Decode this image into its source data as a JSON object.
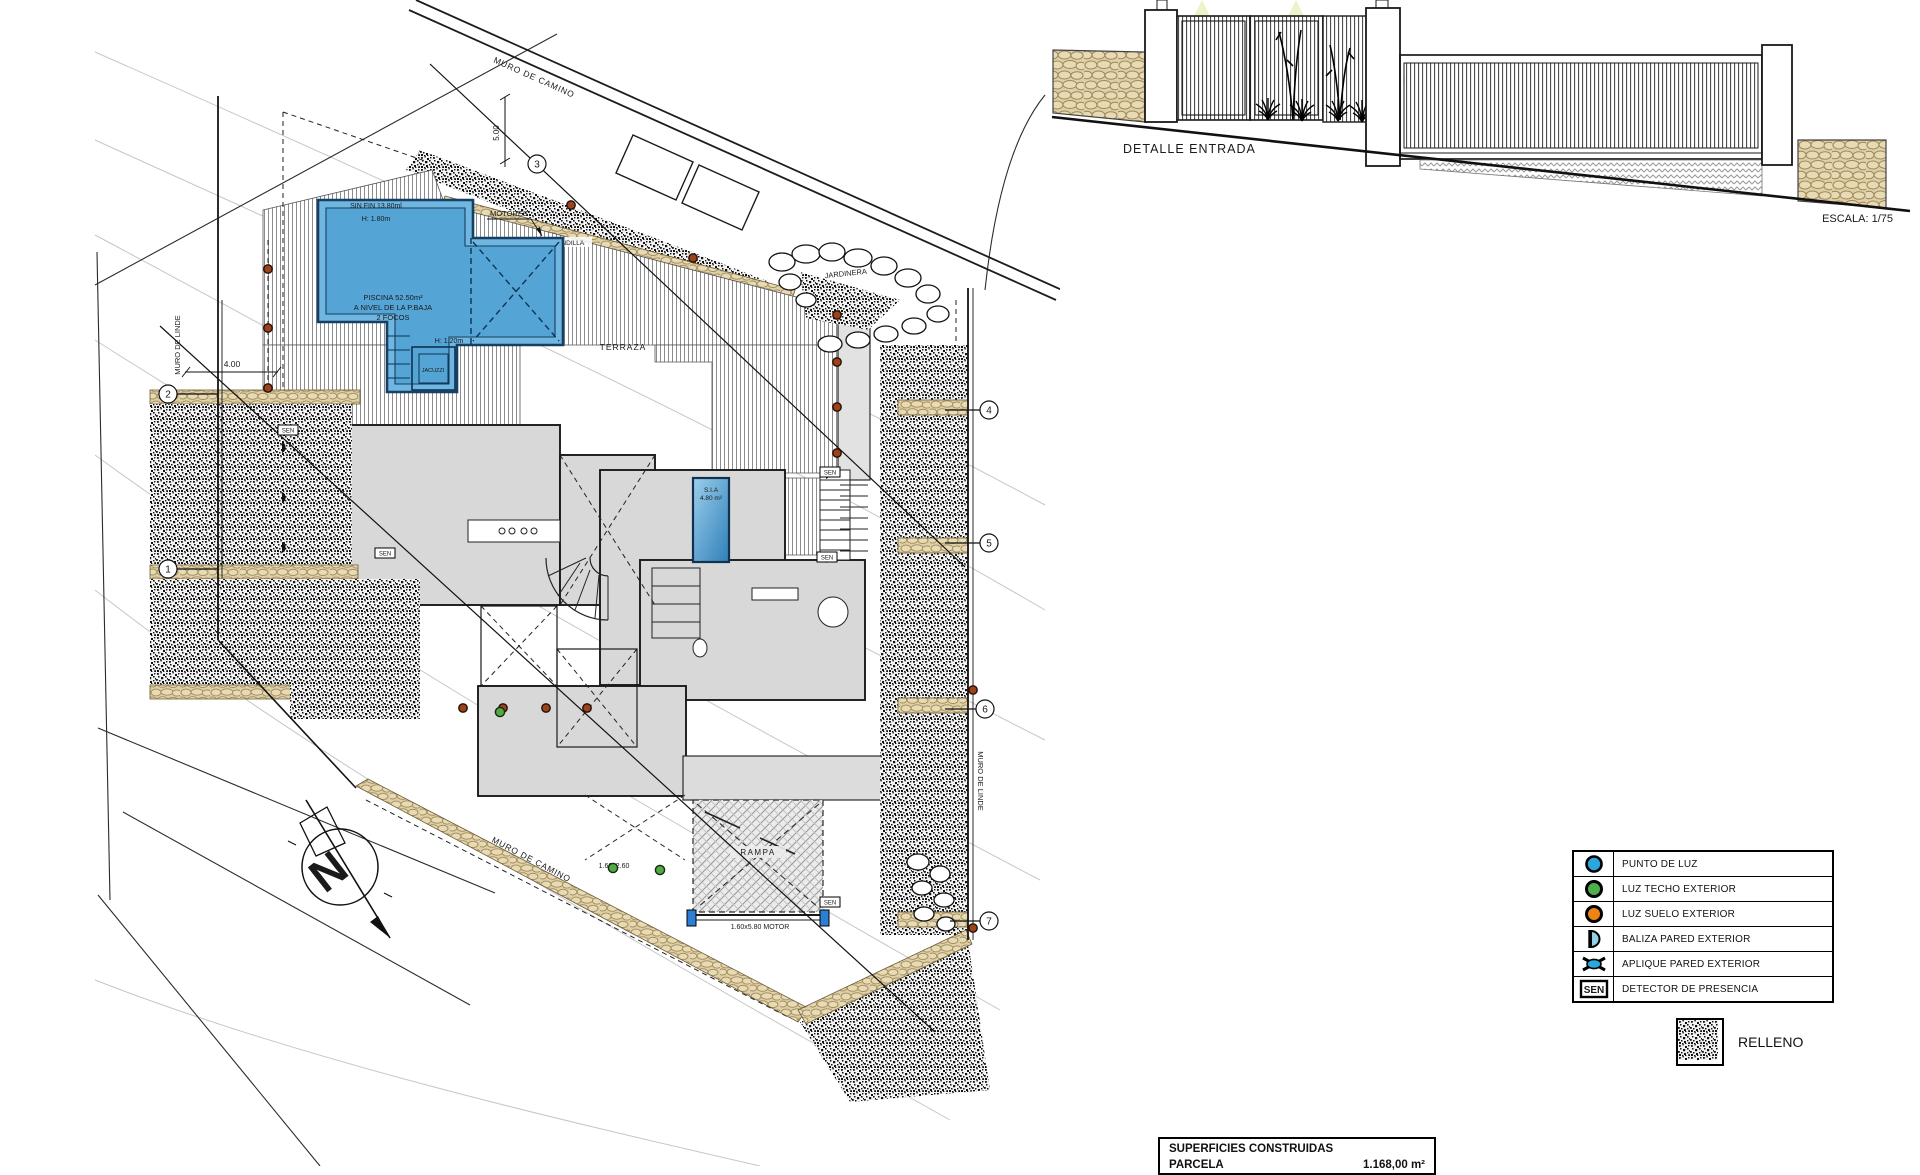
{
  "site_plan": {
    "labels": {
      "muro_de_camino_top": "MURO DE CAMINO",
      "muro_de_camino_bottom": "MURO DE CAMINO",
      "muro_de_linde_left": "MURO DE LINDE",
      "muro_de_linde_right": "MURO DE LINDE",
      "motores": "MOTORES",
      "barandilla_horizontal": "BARANDILLA",
      "barandilla_vertical": "BARANDILLA",
      "jardinera": "JARDINERA",
      "terraza": "TERRAZA",
      "rampa": "RAMPA",
      "motor_gate_dim": "1.60x5.80 MOTOR",
      "pedestrian_gate_dim": "1.60x2.60",
      "sen": "SEN",
      "dim_400": "4.00",
      "dim_500": "5.00",
      "north_letter": "N"
    },
    "pool": {
      "sin_fin": "SIN FIN  13.80ml",
      "h_180": "H: 1.80m",
      "name": "PISCINA 52.50m²",
      "level": "A NIVEL DE LA P.BAJA",
      "focos": "2 FOCOS",
      "h_120": "H: 1.20m",
      "jacuzzi": "JACUZZI"
    },
    "spa": {
      "name": "S.I.A",
      "area": "4.80 m²"
    },
    "axis_markers": [
      "1",
      "2",
      "3",
      "4",
      "5",
      "6",
      "7"
    ]
  },
  "entrance_detail": {
    "title": "DETALLE ENTRADA",
    "scale": "ESCALA: 1/75"
  },
  "legend": {
    "items": [
      {
        "symbol": "punto-de-luz",
        "label": "PUNTO DE LUZ",
        "color": "#2aa7df"
      },
      {
        "symbol": "luz-techo-exterior",
        "label": "LUZ  TECHO EXTERIOR",
        "color": "#4fae4c"
      },
      {
        "symbol": "luz-suelo-exterior",
        "label": "LUZ SUELO EXTERIOR",
        "color": "#ef8414"
      },
      {
        "symbol": "baliza-pared-exterior",
        "label": "BALIZA PARED EXTERIOR",
        "color": "#8fd2e8"
      },
      {
        "symbol": "aplique-pared-exterior",
        "label": "APLIQUE PARED EXTERIOR",
        "color": "#2aa7df"
      },
      {
        "symbol": "detector-presencia",
        "label": "DETECTOR DE PRESENCIA",
        "color": "#000000",
        "text": "SEN"
      }
    ],
    "relleno_label": "RELLENO"
  },
  "surfaces_table": {
    "header": "SUPERFICIES CONSTRUIDAS",
    "rows": [
      {
        "name": "PARCELA",
        "value": "1.168,00 m²"
      }
    ]
  },
  "colors": {
    "pool_fill": "#54a5d6",
    "pool_rim": "#6fb6e0",
    "pool_border": "#163f63",
    "tan_stone": "#dfcfa6",
    "house_gray": "#d8d8d8"
  }
}
